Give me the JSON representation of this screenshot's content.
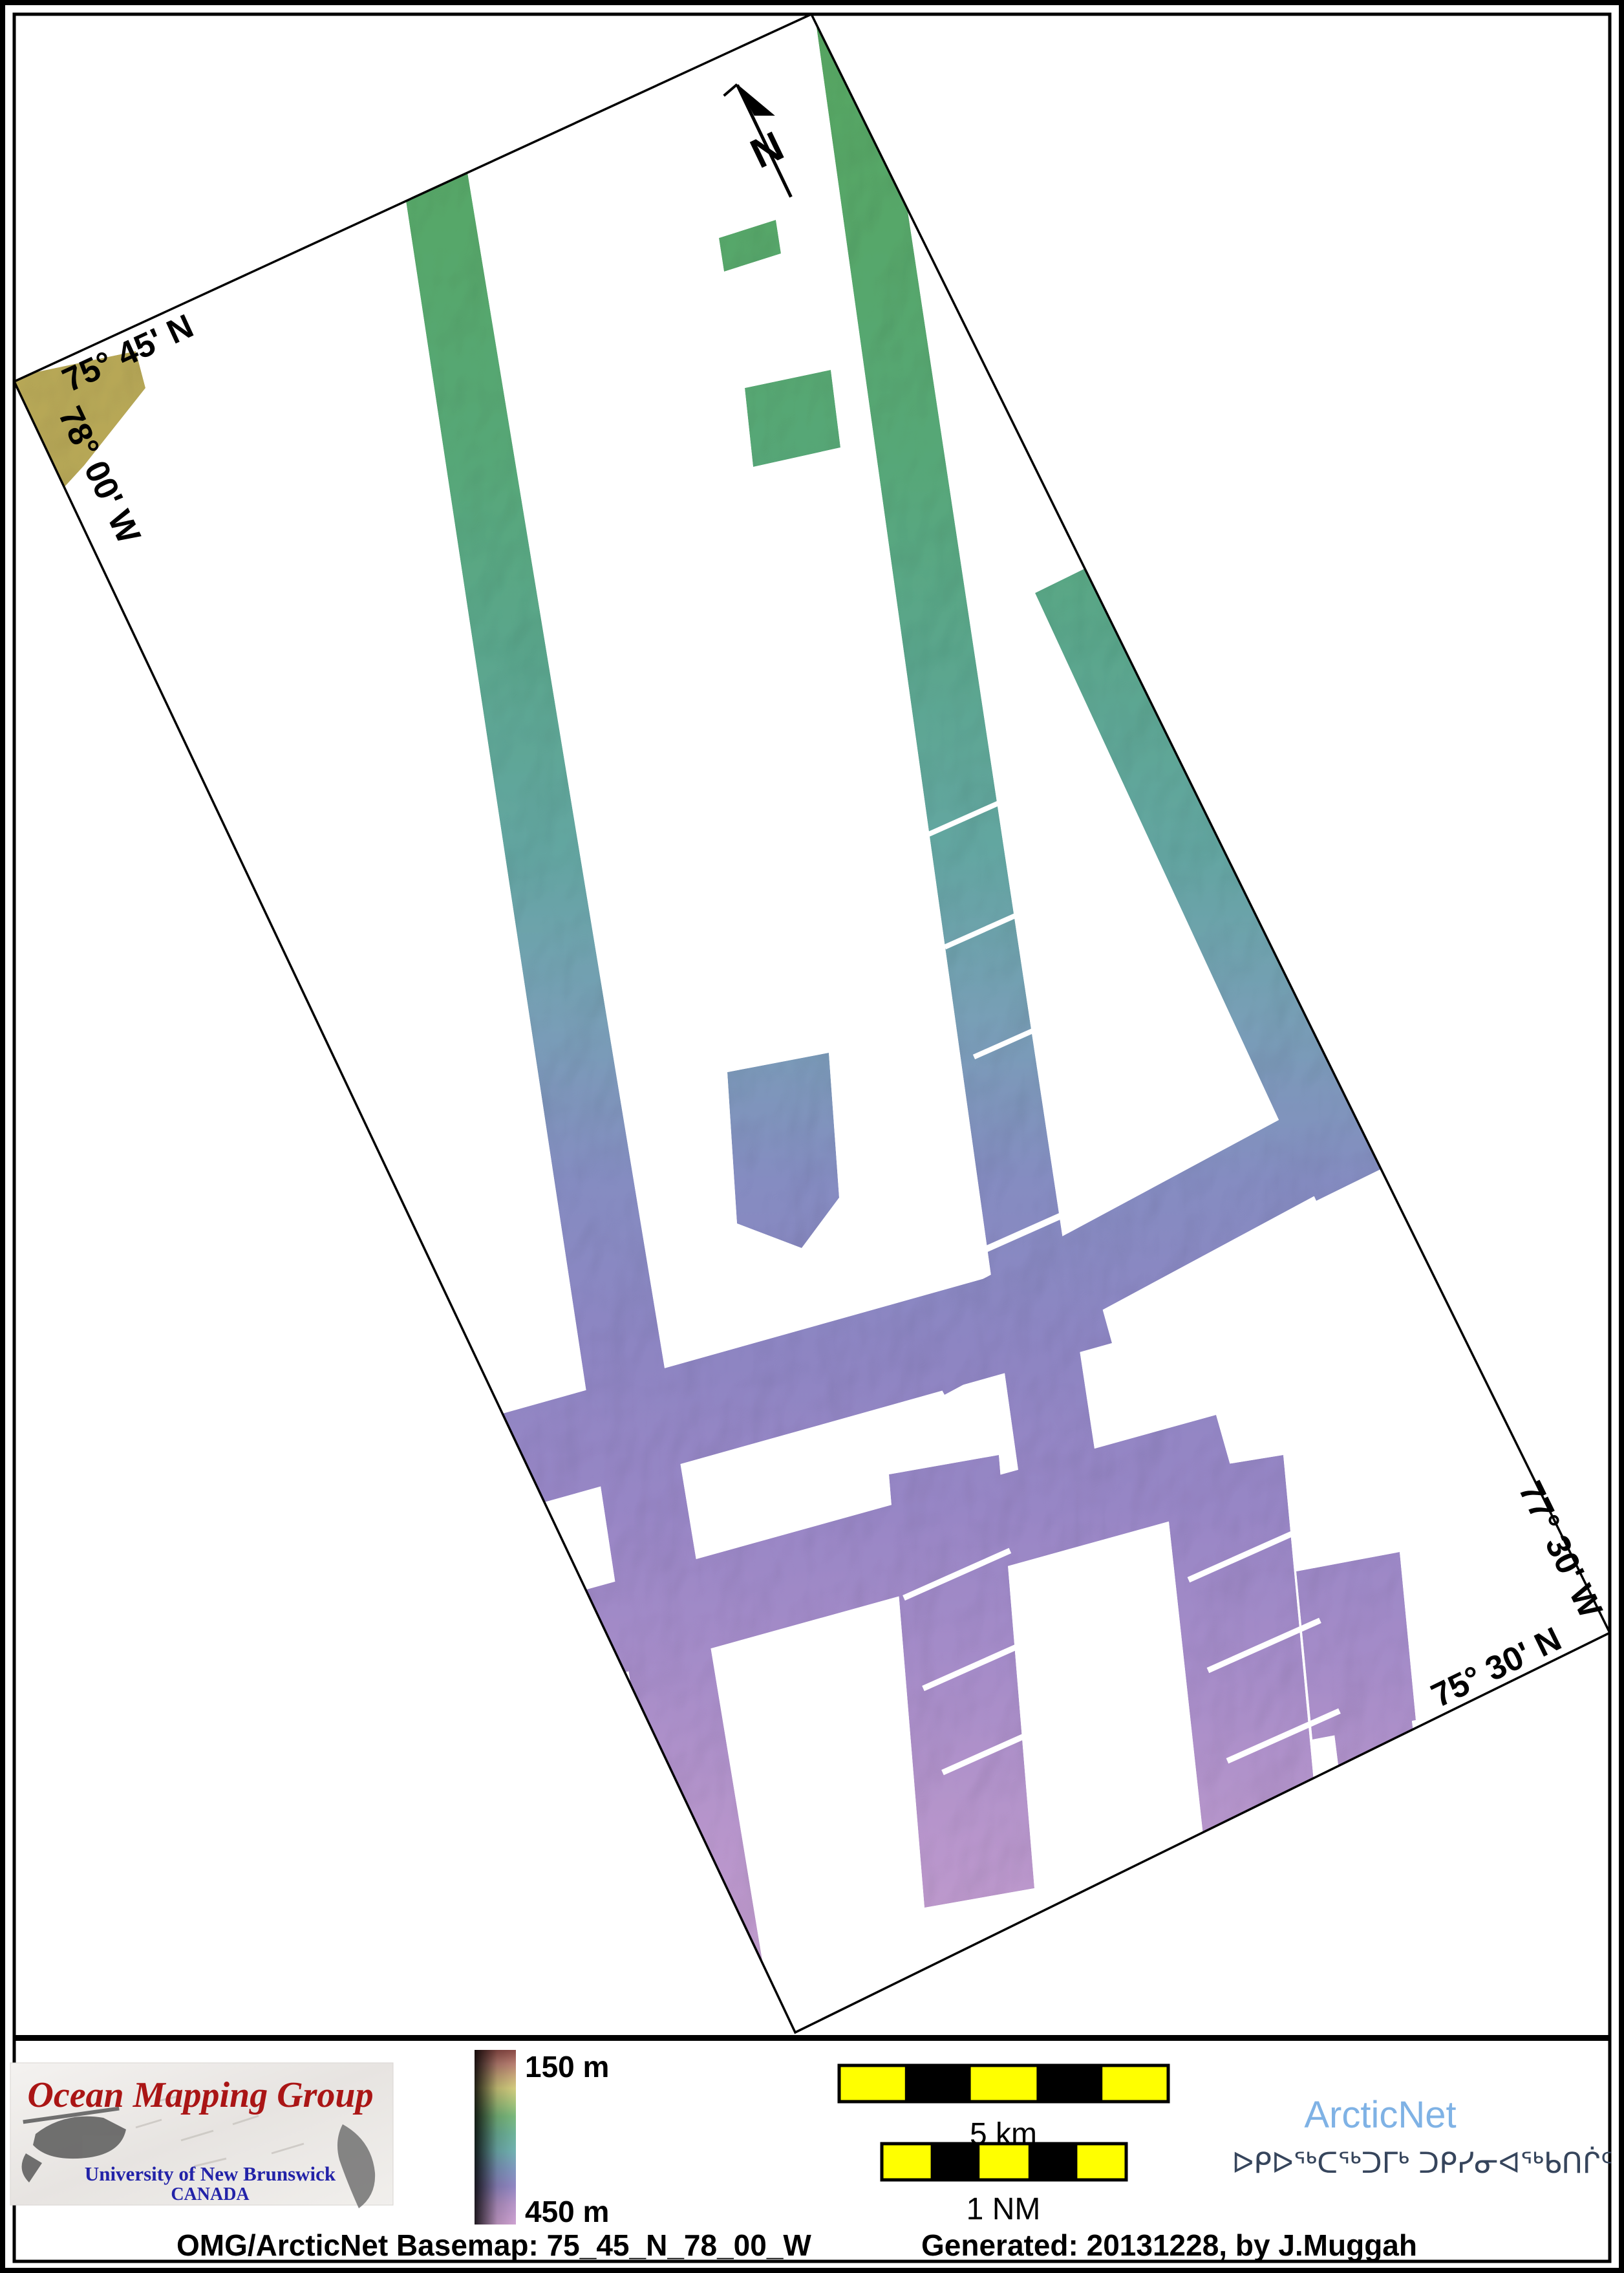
{
  "map": {
    "labels": {
      "top_left_lat": "75° 45' N",
      "left_lon": "78° 00' W",
      "right_lon": "77° 30' W",
      "bottom_right_lat": "75° 30' N"
    },
    "north_label": "N"
  },
  "legend": {
    "top_label": "150 m",
    "bottom_label": "450 m"
  },
  "scale_bars": {
    "km_label": "5 km",
    "nm_label": "1 NM"
  },
  "branding": {
    "omg_title": "Ocean Mapping Group",
    "omg_university": "University of New Brunswick",
    "omg_country": "CANADA",
    "arcticnet_name": "ArcticNet",
    "arcticnet_inuktitut": "ᐅᑭᐅᖅᑕᖅᑐᒥᒃ ᑐᑭᓯᓂᐊᖅᑲᑎᒌᑦ"
  },
  "caption": {
    "basemap": "OMG/ArcticNet Basemap: 75_45_N_78_00_W",
    "generated": "Generated: 20131228, by J.Muggah"
  },
  "colors": {
    "swath_green": "#53a05d",
    "swath_teal": "#61a29e",
    "swath_slate": "#8289bd",
    "swath_purple": "#9483c1",
    "swath_pink": "#c29bca",
    "corner_patch_yellow": "#b3a455",
    "scalebar_yellow": "#ffff00",
    "arcticnet_blue": "#7fb2e5",
    "inuktitut_navy": "#36455c",
    "omg_red": "#aa1515",
    "unb_blue": "#2323a8",
    "frame_black": "#000000"
  }
}
